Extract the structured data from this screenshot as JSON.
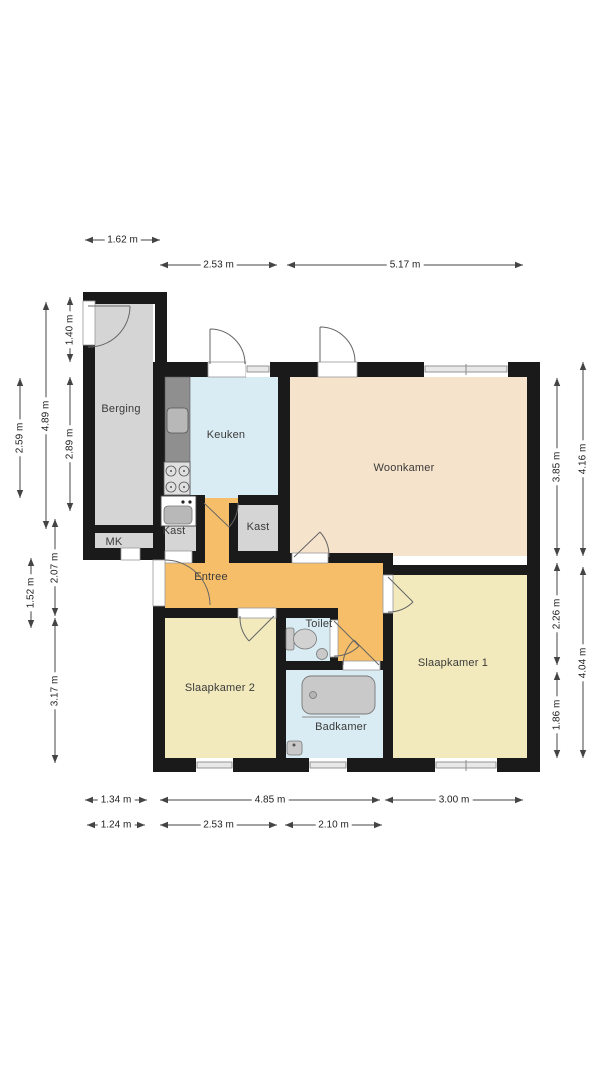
{
  "plan_title": "Floor plan (plattegrond)",
  "colors": {
    "background": "#ffffff",
    "wall": "#1a1a1a",
    "room_gray": "#d5d5d5",
    "room_blue": "#d9ecf3",
    "room_peach": "#f6e3cb",
    "room_orange": "#f6be68",
    "room_yellow": "#f2eabd",
    "fixture_gray": "#c9c9c9",
    "fixture_light": "#e0e0e0",
    "counter_gray": "#8f8f8f",
    "sink_gray": "#b8b8b8",
    "door_white": "#ffffff",
    "window_inner": "#e8e8e8",
    "arc_stroke": "#666666",
    "dim_line": "#444444",
    "dim_text": "#222222",
    "label_text": "#3a3a3a"
  },
  "rooms": [
    {
      "id": "berging",
      "label": "Berging",
      "x": 121,
      "y": 409
    },
    {
      "id": "mk",
      "label": "MK",
      "x": 114,
      "y": 542
    },
    {
      "id": "keuken",
      "label": "Keuken",
      "x": 226,
      "y": 435
    },
    {
      "id": "woonkamer",
      "label": "Woonkamer",
      "x": 404,
      "y": 468
    },
    {
      "id": "kast-left",
      "label": "Kast",
      "x": 174,
      "y": 531
    },
    {
      "id": "kast-right",
      "label": "Kast",
      "x": 258,
      "y": 527
    },
    {
      "id": "entree",
      "label": "Entree",
      "x": 211,
      "y": 577
    },
    {
      "id": "toilet",
      "label": "Toilet",
      "x": 319,
      "y": 624
    },
    {
      "id": "slaapkamer-2",
      "label": "Slaapkamer 2",
      "x": 220,
      "y": 688
    },
    {
      "id": "badkamer",
      "label": "Badkamer",
      "x": 341,
      "y": 727
    },
    {
      "id": "slaapkamer-1",
      "label": "Slaapkamer 1",
      "x": 453,
      "y": 663
    }
  ],
  "dimensions": [
    {
      "label": "1.62 m",
      "orient": "h",
      "x1": 85,
      "x2": 160,
      "y": 240
    },
    {
      "label": "2.53 m",
      "orient": "h",
      "x1": 160,
      "x2": 277,
      "y": 265
    },
    {
      "label": "5.17 m",
      "orient": "h",
      "x1": 287,
      "x2": 523,
      "y": 265
    },
    {
      "label": "1.34 m",
      "orient": "h",
      "x1": 85,
      "x2": 147,
      "y": 800
    },
    {
      "label": "4.85 m",
      "orient": "h",
      "x1": 160,
      "x2": 380,
      "y": 800
    },
    {
      "label": "3.00 m",
      "orient": "h",
      "x1": 385,
      "x2": 523,
      "y": 800
    },
    {
      "label": "1.24 m",
      "orient": "h",
      "x1": 87,
      "x2": 145,
      "y": 825
    },
    {
      "label": "2.53 m",
      "orient": "h",
      "x1": 160,
      "x2": 277,
      "y": 825
    },
    {
      "label": "2.10 m",
      "orient": "h",
      "x1": 285,
      "x2": 382,
      "y": 825
    },
    {
      "label": "1.40 m",
      "orient": "v",
      "x": 70,
      "y1": 297,
      "y2": 362
    },
    {
      "label": "2.89 m",
      "orient": "v",
      "x": 70,
      "y1": 377,
      "y2": 511
    },
    {
      "label": "4.89 m",
      "orient": "v",
      "x": 46,
      "y1": 302,
      "y2": 529
    },
    {
      "label": "2.07 m",
      "orient": "v",
      "x": 55,
      "y1": 519,
      "y2": 616
    },
    {
      "label": "3.17 m",
      "orient": "v",
      "x": 55,
      "y1": 618,
      "y2": 763
    },
    {
      "label": "2.59 m",
      "orient": "v",
      "x": 20,
      "y1": 378,
      "y2": 498
    },
    {
      "label": "1.52 m",
      "orient": "v",
      "x": 31,
      "y1": 558,
      "y2": 628
    },
    {
      "label": "3.85 m",
      "orient": "v",
      "x": 557,
      "y1": 378,
      "y2": 556
    },
    {
      "label": "2.26 m",
      "orient": "v",
      "x": 557,
      "y1": 563,
      "y2": 665
    },
    {
      "label": "1.86 m",
      "orient": "v",
      "x": 557,
      "y1": 672,
      "y2": 758
    },
    {
      "label": "4.16 m",
      "orient": "v",
      "x": 583,
      "y1": 362,
      "y2": 556
    },
    {
      "label": "4.04 m",
      "orient": "v",
      "x": 583,
      "y1": 567,
      "y2": 758
    }
  ]
}
